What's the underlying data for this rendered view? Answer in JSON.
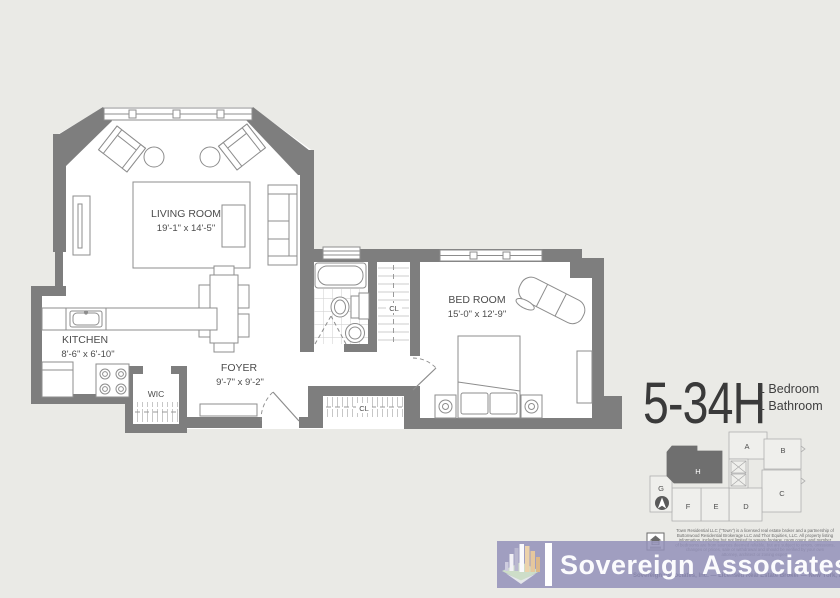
{
  "unit": {
    "number": "5-34H",
    "spec_bedrooms": "1 Bedroom",
    "spec_bathrooms": "1 Bathroom"
  },
  "rooms": {
    "living": {
      "name": "LIVING ROOM",
      "dims": "19'-1\" x 14'-5\""
    },
    "kitchen": {
      "name": "KITCHEN",
      "dims": "8'-6\" x 6'-10\""
    },
    "foyer": {
      "name": "FOYER",
      "dims": "9'-7\" x 9'-2\""
    },
    "bedroom": {
      "name": "BED ROOM",
      "dims": "15'-0\" x 12'-9\""
    },
    "wic": {
      "name": "WIC"
    },
    "hall_closet": {
      "name": "CL"
    },
    "entry_closet": {
      "name": "CL"
    }
  },
  "keyplan": {
    "units": [
      "A",
      "B",
      "C",
      "D",
      "E",
      "F",
      "G",
      "H"
    ],
    "highlighted": "H"
  },
  "branding": {
    "company": "Sovereign Associates"
  },
  "disclaimer": {
    "lines": [
      "Town Residential LLC (\"Town\") is a licensed real estate broker and a partnership of",
      "Buttonwood Residential Brokerage LLC and Thor Equities, LLC. All property listing",
      "information, including but not limited to square footage, room count, and number",
      "of bedrooms are from sources deemed reliable, but are subject to errors, omissions,",
      "changes or prices, sale or withdrawal and should be verified by your own",
      "attorney, architect or zoning expert.",
      "Sovereign Associates, Inc. — Licensed Real Estate Broker — New York, NY"
    ]
  },
  "colors": {
    "background": "#eaeae6",
    "wall": "#7e7e7e",
    "floor": "#ffffff",
    "line": "#8d8d8d",
    "label": "#4c4c4c",
    "banner": "#9391b8",
    "keyplan_highlight": "#6f6f6f",
    "logo_orange": "#e7c9a0",
    "logo_green": "#cdddc8"
  }
}
